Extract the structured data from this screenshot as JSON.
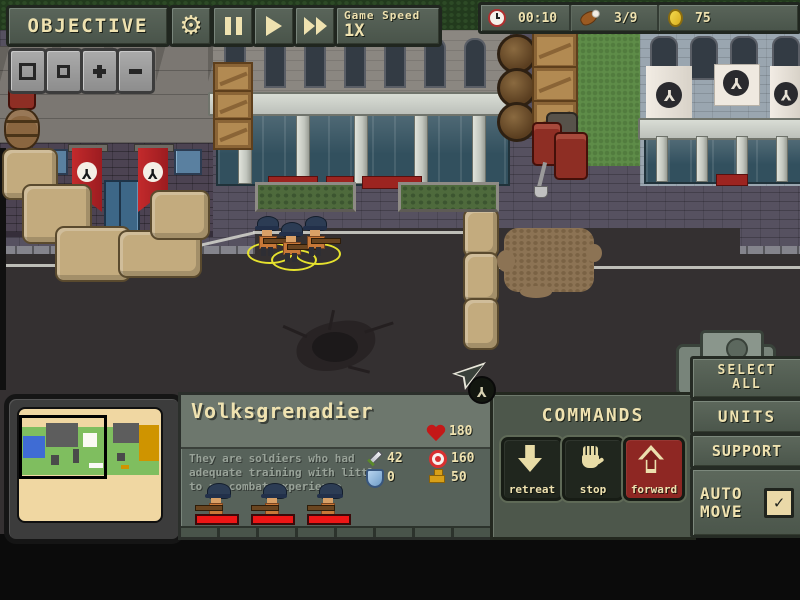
{
  "colors": {
    "panel_green": "#4e584c",
    "panel_green_light": "#6d786d",
    "cream_text": "#efe2b0",
    "panel_border": "#20261f",
    "banner_red": "#ab2026",
    "forward_button_red": "#8e2723",
    "health_bar_red": "#ee1616",
    "selection_ring_yellow": "#e6e22e",
    "minimap_cream": "#f0d7a2",
    "coin_gold": "#e8c832"
  },
  "top_bar": {
    "objective_label": "OBJECTIVE",
    "game_speed_label": "Game Speed",
    "game_speed_value": "1X"
  },
  "resources": {
    "time": "00:10",
    "rations": "3/9",
    "gold": "75"
  },
  "unit_panel": {
    "title": "Volksgrenadier",
    "description_lines": [
      "They are soldiers who had",
      "adequate training with little",
      "to no combat experience"
    ],
    "stats": {
      "health": "180",
      "attack": "42",
      "accuracy": "160",
      "armor": "0",
      "speed": "50"
    }
  },
  "commands": {
    "title": "COMMANDS",
    "buttons": [
      {
        "label": "retreat"
      },
      {
        "label": "stop"
      },
      {
        "label": "forward"
      }
    ]
  },
  "side_menu": {
    "select_all_line1": "SELECT",
    "select_all_line2": "ALL",
    "units_label": "UNITS",
    "support_label": "SUPPORT",
    "auto_move_line1": "AUTO",
    "auto_move_line2": "MOVE",
    "auto_move_checked": true,
    "check_glyph": "✓"
  },
  "scene": {
    "emblem_glyph": "Y"
  }
}
